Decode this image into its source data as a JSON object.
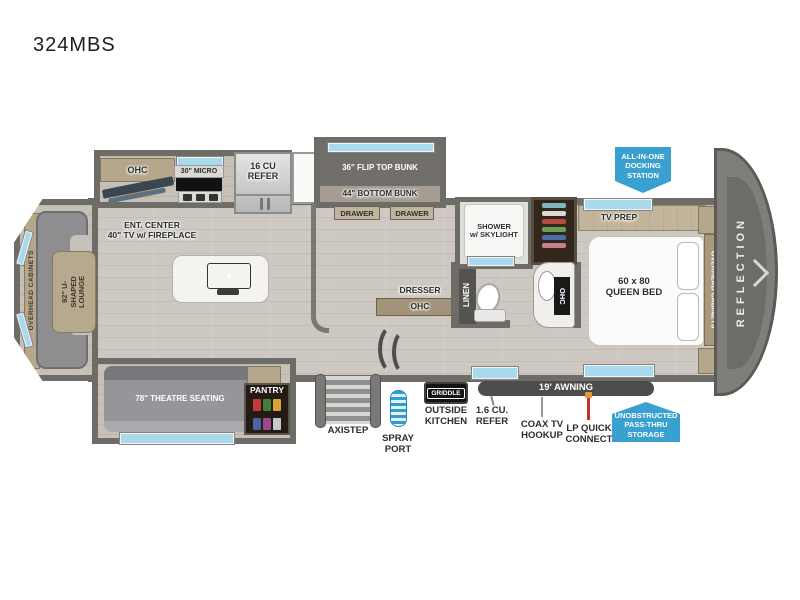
{
  "title": "324MBS",
  "colors": {
    "badge_blue": "#3aa0cf",
    "wall_gray": "#6e6c67",
    "floor_wood": "#cdc8c1",
    "window_blue": "#a9d9ec",
    "awning_gray": "#4c4c4a",
    "fireplace_orange": "#e8963c"
  },
  "lounge": {
    "overhead": "OVERHEAD CABINETS",
    "label": "92\" U-SHAPED\nLOUNGE"
  },
  "kitchen": {
    "ohc": "OHC",
    "micro": "30\" MICRO",
    "refer": "16 CU\nREFER",
    "ent": "ENT. CENTER\n40\" TV w/ FIREPLACE"
  },
  "bunk": {
    "flip": "36\" FLIP TOP BUNK",
    "bottom": "44\" BOTTOM BUNK",
    "drawer_l": "DRAWER",
    "drawer_r": "DRAWER"
  },
  "bath": {
    "shower": "SHOWER\nw/ SKYLIGHT",
    "linen": "LINEN",
    "ohc": "OHC"
  },
  "hall": {
    "dresser": "DRESSER",
    "ohc": "OHC"
  },
  "bedroom": {
    "tv_prep": "TV PREP",
    "bed": "60 x 80\nQUEEN BED",
    "overhead": "OVERHEAD CABINETS",
    "brand": "REFLECTION",
    "docking": "ALL-IN-ONE\nDOCKING\nSTATION"
  },
  "exterior": {
    "theatre": "78\" THEATRE SEATING",
    "pantry": "PANTRY",
    "axistep": "AXISTEP",
    "spray": "SPRAY\nPORT",
    "griddle": "GRIDDLE",
    "outside_kitchen": "OUTSIDE\nKITCHEN",
    "small_refer": "1.6 CU.\nREFER",
    "awning": "19' AWNING",
    "coax": "COAX TV\nHOOKUP",
    "lp": "LP QUICK\nCONNECT",
    "storage": "UNOBSTRUCTED\nPASS-THRU\nSTORAGE"
  }
}
